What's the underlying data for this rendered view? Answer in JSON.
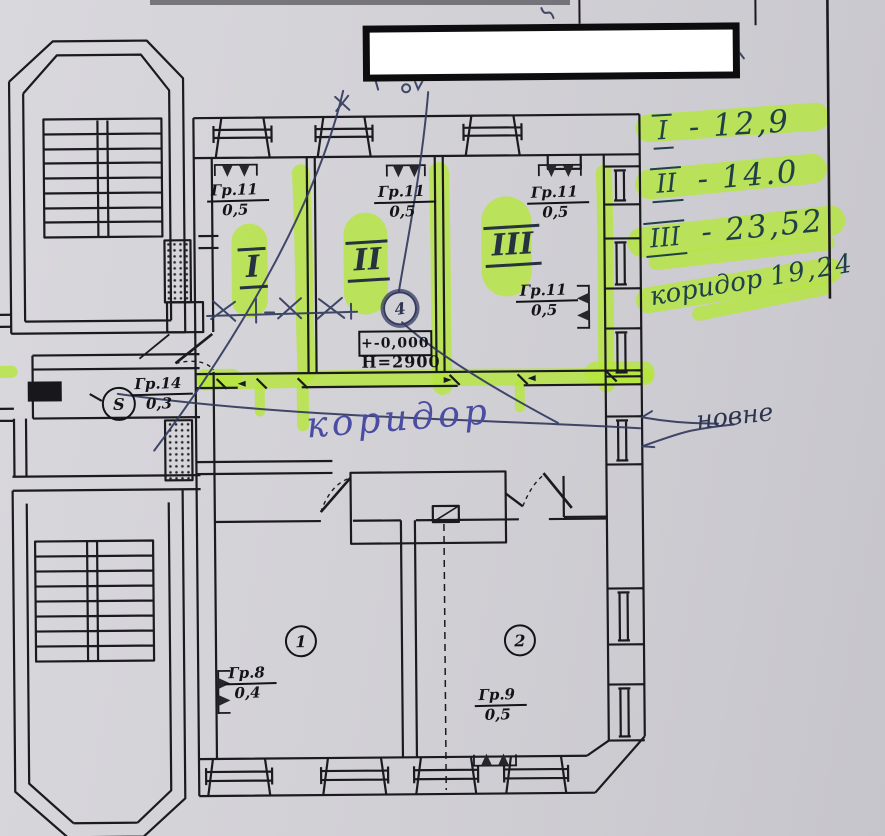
{
  "colors": {
    "paper": "#d2d1d6",
    "ink": "#17171c",
    "pen": "#323a5e",
    "marker": "#b5e63c",
    "note_ink": "#1f4049",
    "corridor_pen": "#4a4da1"
  },
  "plan": {
    "room_marks": {
      "r1": "I",
      "r2": "II",
      "r3": "III"
    },
    "circle_marks": {
      "room1": "1",
      "room2": "2",
      "node4": "4",
      "sensorS": "S"
    },
    "elevation": {
      "level": "+-0,000",
      "height": "Н=2900"
    },
    "corridor_label": "коридор",
    "fraction_labels": {
      "gr11_room1": {
        "num": "Гр.11",
        "den": "0,5"
      },
      "gr11_room2": {
        "num": "Гр.11",
        "den": "0,5"
      },
      "gr11_room3_top": {
        "num": "Гр.11",
        "den": "0,5"
      },
      "gr11_room3_side": {
        "num": "Гр.11",
        "den": "0,5"
      },
      "gr14": {
        "num": "Гр.14",
        "den": "0,3"
      },
      "gr8": {
        "num": "Гр.8",
        "den": "0,4"
      },
      "gr9": {
        "num": "Гр.9",
        "den": "0,5"
      }
    }
  },
  "annotations": {
    "area_notes": [
      {
        "roman": "I",
        "text": "- 12,9"
      },
      {
        "roman": "II",
        "text": "- 14.0"
      },
      {
        "roman": "III",
        "text": "- 23,52"
      },
      {
        "label": "коридор",
        "text": "19,24"
      }
    ],
    "side_note": "новне"
  }
}
